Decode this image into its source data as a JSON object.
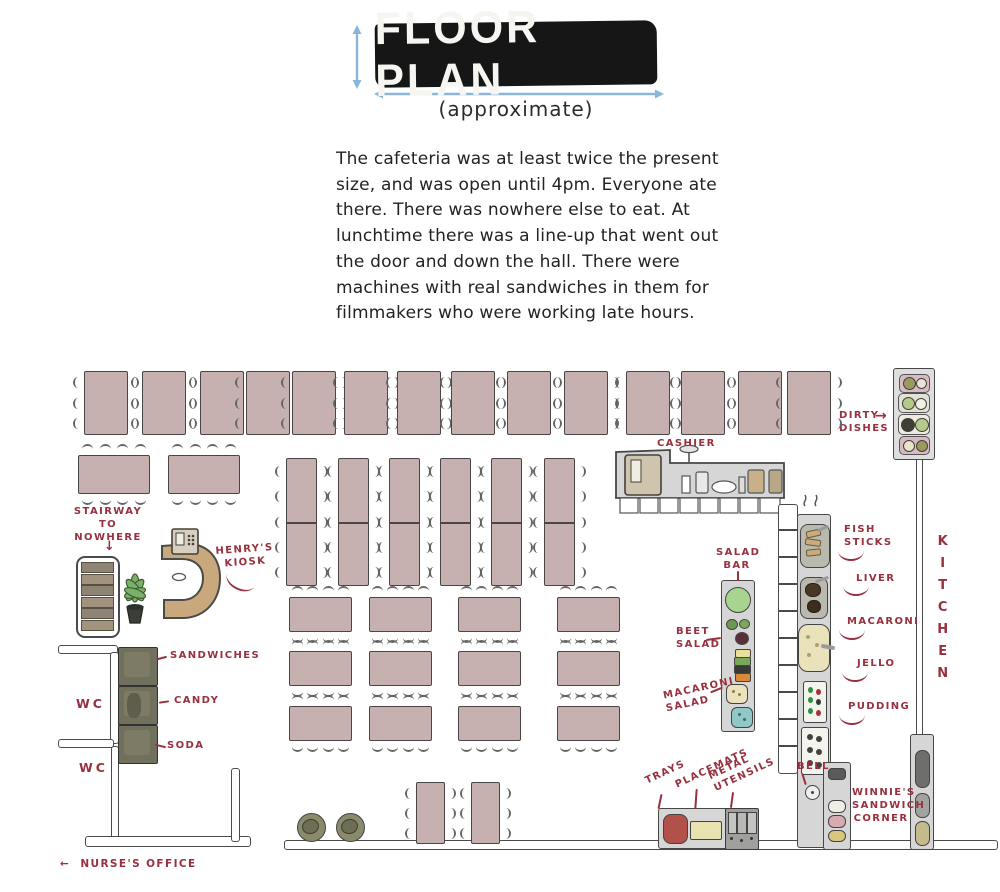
{
  "header": {
    "title": "FLOOR PLAN",
    "subtitle": "(approximate)"
  },
  "intro_lines": [
    "The cafeteria was at least twice the present",
    "size, and was open until 4pm. Everyone ate",
    "there. There was nowhere else to eat. At",
    "lunchtime there was a line-up that went out",
    "the door and down the hall. There were",
    "machines with real sandwiches in them for",
    "filmmakers who were working late hours."
  ],
  "labels": {
    "stairway": "STAIRWAY\nTO\nNOWHERE",
    "henrys_kiosk": "HENRY'S\nKIOSK",
    "sandwiches": "SANDWICHES",
    "candy": "CANDY",
    "soda": "SODA",
    "wc_upper": "WC",
    "wc_lower": "WC",
    "nurses_office": "NURSE'S OFFICE",
    "cashier": "CASHIER",
    "dirty_dishes": "DIRTY\nDISHES",
    "kitchen": "KITCHEN",
    "salad_bar": "SALAD\nBAR",
    "beet_salad": "BEET\nSALAD",
    "macaroni_salad": "MACARONI\nSALAD",
    "fish_sticks": "FISH\nSTICKS",
    "liver": "LIVER",
    "macaroni": "MACARONI",
    "jello": "JELLO",
    "pudding": "PUDDING",
    "trays": "TRAYS",
    "placemats": "PLACEMATS",
    "metal_utensils": "METAL\nUTENSILS",
    "bell": "BELL",
    "winnies_corner": "WINNIE'S\nSANDWICH\nCORNER"
  },
  "icons": {
    "left_arrow": "←",
    "right_arrow": "→",
    "down_arrow": "↓"
  },
  "floor": {
    "table_counts": {
      "top_row": 14,
      "second_row": 2,
      "long_tables": 6,
      "grid_rows": 3,
      "grid_cols": 4,
      "bottom_tables": 2,
      "trash_cans": 2
    }
  },
  "colors": {
    "label_red": "#98303e",
    "table_fill": "#c6b0b0",
    "banner_black": "#161616",
    "arrow_blue": "#8ab7d9",
    "counter_gray": "#d6d6d6",
    "machine_olive": "#71705c",
    "kiosk_tan": "#c9a87e",
    "plant_green": "#7cb06a"
  }
}
